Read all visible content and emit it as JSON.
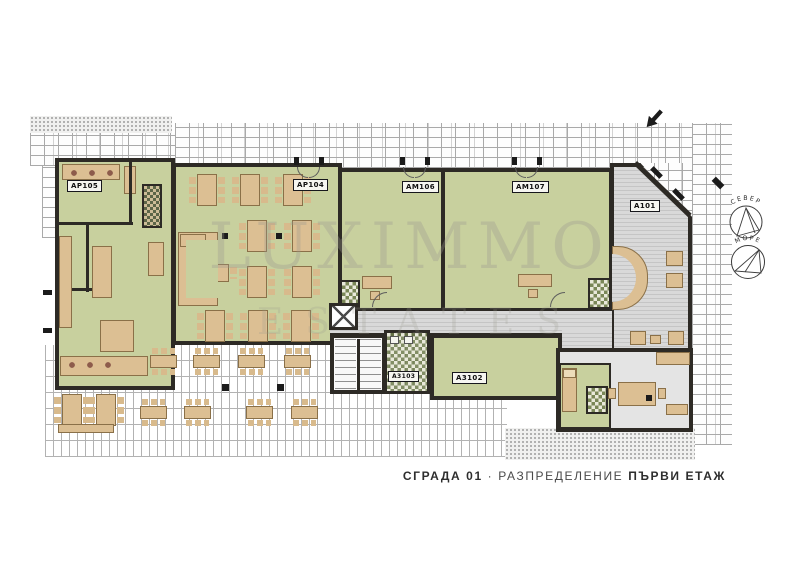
{
  "rooms": {
    "ar105": "АР105",
    "ar104": "АР104",
    "am106": "АМ106",
    "am107": "АМ107",
    "a101": "А101",
    "a3103": "А3103",
    "a3102": "А3102"
  },
  "compass": {
    "north": "СЕВЕР",
    "sea": "МОРЕ"
  },
  "watermark": {
    "line1": "LUXIMMO",
    "line2": "ESTATES"
  },
  "title_block": {
    "building": "СГРАДА 01",
    "separator": "·",
    "layout_word": "РАЗПРЕДЕЛЕНИЕ",
    "floor": "ПЪРВИ ЕТАЖ"
  },
  "colors": {
    "floor_green": "#c8d09e",
    "furniture_tan": "#dcbf93",
    "wall": "#2d2a25",
    "paving_line": "#a9a9a9"
  }
}
